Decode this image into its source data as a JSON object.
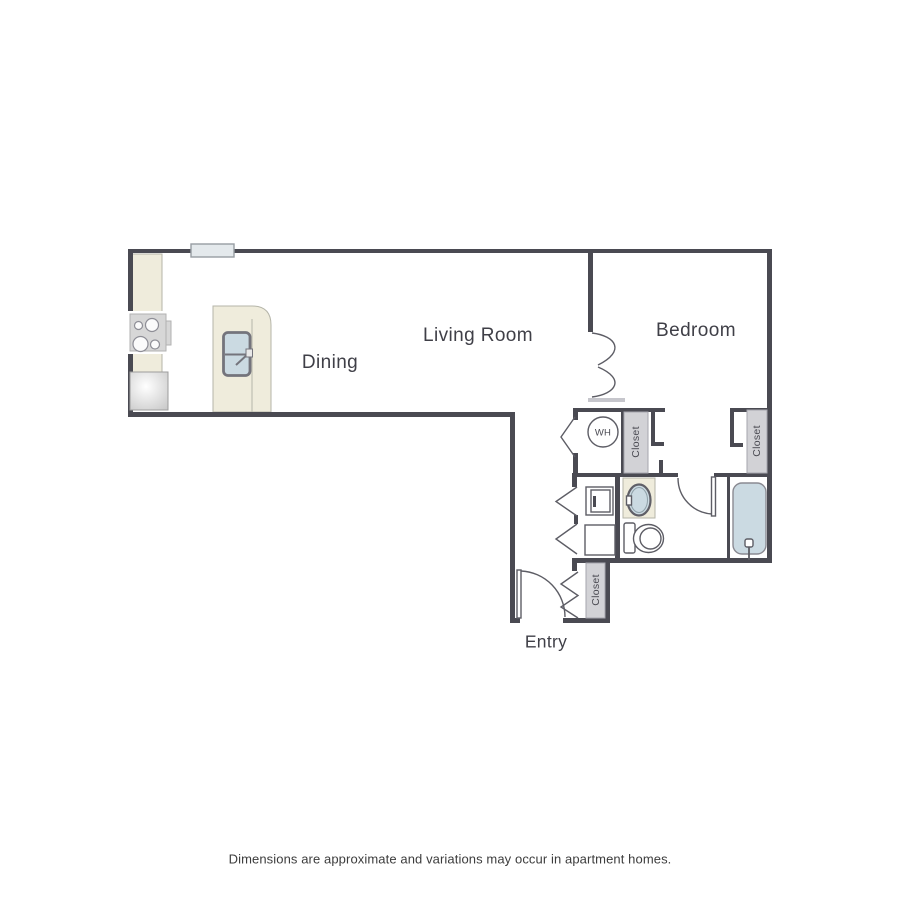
{
  "page": {
    "background": "#ffffff",
    "disclaimer": "Dimensions are approximate and variations may occur in apartment homes."
  },
  "floorplan": {
    "rooms": {
      "living_room": {
        "label": "Living Room"
      },
      "dining": {
        "label": "Dining"
      },
      "bedroom": {
        "label": "Bedroom"
      },
      "entry": {
        "label": "Entry"
      }
    },
    "closets": {
      "hall": {
        "label": "Closet"
      },
      "bedroom": {
        "label": "Closet"
      },
      "entry": {
        "label": "Closet"
      }
    },
    "water_heater": {
      "label": "WH"
    },
    "fixtures": [
      "window",
      "stove",
      "refrigerator",
      "kitchen-island-sink",
      "dryer",
      "washer",
      "vanity-sink",
      "toilet",
      "bathtub",
      "entry-door",
      "bathroom-door",
      "bedroom-double-door",
      "bifold-doors"
    ],
    "colors": {
      "wall": "#4a4a52",
      "line": "#5d5d65",
      "closet_fill": "#d2d2d6",
      "counter": "#efecdc",
      "water_blue": "#cbdae2",
      "appliance": "#d7d7d7",
      "text": "#3f3f47",
      "muted_text": "#4a4a52"
    }
  }
}
